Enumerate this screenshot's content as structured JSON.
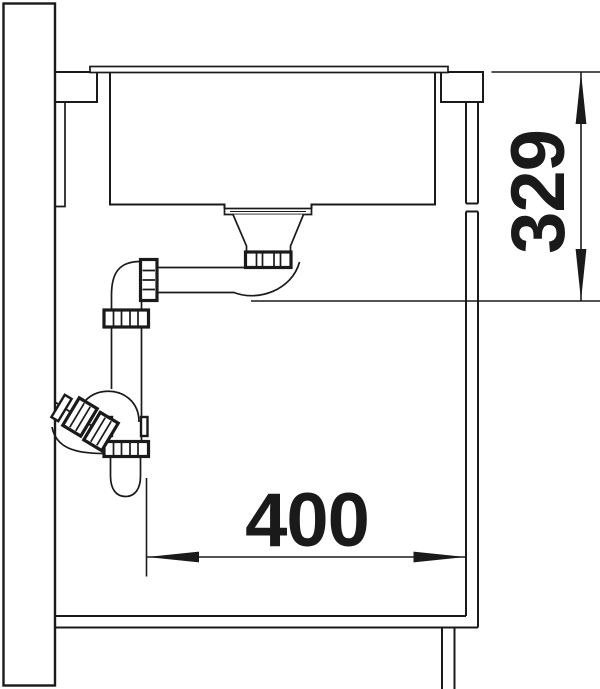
{
  "diagram": {
    "dim_vertical": {
      "value": "329"
    },
    "dim_horizontal": {
      "value": "400"
    },
    "line_color": "#1a1a1a",
    "background_color": "#ffffff"
  }
}
